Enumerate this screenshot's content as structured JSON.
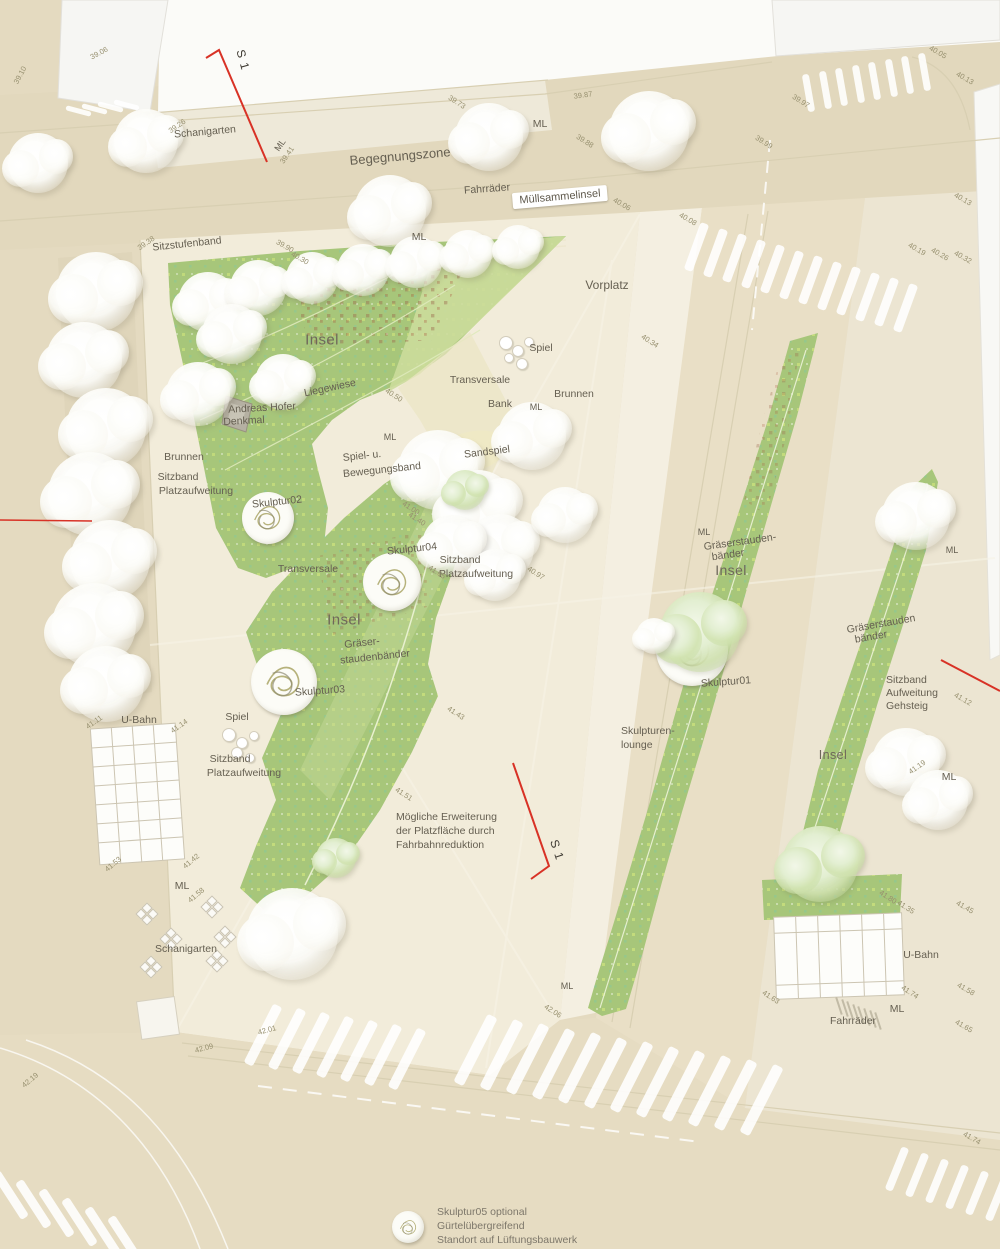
{
  "plan_title": "Site plan (Platzgestaltung)",
  "palette": {
    "street": "#e4dac0",
    "road": "#e9dfc6",
    "plaza": "#f2ecda",
    "sidewalk": "#ece5d2",
    "lounge": "#f4efe1",
    "schani": "#eee9d9",
    "paper": "#fbfbf8",
    "building": "#f6f6f3",
    "green": "#a7c67a",
    "greenlight": "#c3d795",
    "pale": "#dfe7b4",
    "sand": "#efe9c5",
    "red": "#d83226",
    "label": "#655f51",
    "elev": "#97906f",
    "grid": "#ccc5b2",
    "curb": "#d8cfb2"
  },
  "labels": [
    {
      "id": "schanigarten-top",
      "t": "Schanigarten",
      "x": 205,
      "y": 132,
      "r": -5
    },
    {
      "id": "ml-1",
      "t": "ML",
      "x": 280,
      "y": 145,
      "r": -55,
      "c": "small"
    },
    {
      "id": "begegnungszone",
      "t": "Begegnungszone",
      "x": 400,
      "y": 156,
      "r": -5,
      "c": "big2"
    },
    {
      "id": "fahrraeder-top",
      "t": "Fahrräder",
      "x": 487,
      "y": 189,
      "r": -4
    },
    {
      "id": "ml-2",
      "t": "ML",
      "x": 540,
      "y": 124,
      "r": 0
    },
    {
      "id": "muellsammelinsel",
      "t": "Müllsammelinsel",
      "x": 560,
      "y": 197,
      "r": -5,
      "c": "boxed"
    },
    {
      "id": "sitzstufenband",
      "t": "Sitzstufenband",
      "x": 187,
      "y": 244,
      "r": -6
    },
    {
      "id": "ml-3",
      "t": "ML",
      "x": 419,
      "y": 237,
      "r": 0
    },
    {
      "id": "insel-a",
      "t": "Insel",
      "x": 322,
      "y": 340,
      "r": 0,
      "c": "big"
    },
    {
      "id": "vorplatz",
      "t": "Vorplatz",
      "x": 607,
      "y": 285,
      "r": 0,
      "c": "med2"
    },
    {
      "id": "spiel-1",
      "t": "Spiel",
      "x": 541,
      "y": 348,
      "r": 0
    },
    {
      "id": "transversale-1",
      "t": "Transversale",
      "x": 480,
      "y": 380,
      "r": 0
    },
    {
      "id": "bank",
      "t": "Bank",
      "x": 500,
      "y": 404,
      "r": 0
    },
    {
      "id": "ml-4",
      "t": "ML",
      "x": 536,
      "y": 407,
      "r": 0,
      "c": "small"
    },
    {
      "id": "brunnen-1",
      "t": "Brunnen",
      "x": 574,
      "y": 394,
      "r": 0
    },
    {
      "id": "liegewiese",
      "t": "Liegewiese",
      "x": 330,
      "y": 388,
      "r": -12
    },
    {
      "id": "andreas-hofer-1",
      "t": "Andreas Hofer",
      "x": 262,
      "y": 408,
      "r": -3
    },
    {
      "id": "andreas-hofer-2",
      "t": "Denkmal",
      "x": 244,
      "y": 421,
      "r": -3
    },
    {
      "id": "ml-5",
      "t": "ML",
      "x": 390,
      "y": 437,
      "r": 0,
      "c": "small"
    },
    {
      "id": "spielband-1",
      "t": "Spiel- u.",
      "x": 362,
      "y": 456,
      "r": -6
    },
    {
      "id": "spielband-2",
      "t": "Bewegungsband",
      "x": 382,
      "y": 470,
      "r": -6
    },
    {
      "id": "sandspiel",
      "t": "Sandspiel",
      "x": 487,
      "y": 452,
      "r": -7
    },
    {
      "id": "brunnen-2",
      "t": "Brunnen",
      "x": 184,
      "y": 457,
      "r": 0
    },
    {
      "id": "sitzband-1a",
      "t": "Sitzband",
      "x": 178,
      "y": 477,
      "r": 0
    },
    {
      "id": "sitzband-1b",
      "t": "Platzaufweitung",
      "x": 196,
      "y": 491,
      "r": 0
    },
    {
      "id": "skulptur02",
      "t": "Skulptur02",
      "x": 277,
      "y": 502,
      "r": -6
    },
    {
      "id": "transversale-2",
      "t": "Transversale",
      "x": 308,
      "y": 569,
      "r": 0
    },
    {
      "id": "skulptur04",
      "t": "Skulptur04",
      "x": 412,
      "y": 549,
      "r": -6
    },
    {
      "id": "sitzband-2a",
      "t": "Sitzband",
      "x": 460,
      "y": 560,
      "r": 0
    },
    {
      "id": "sitzband-2b",
      "t": "Platzaufweitung",
      "x": 476,
      "y": 574,
      "r": 0
    },
    {
      "id": "insel-b",
      "t": "Insel",
      "x": 344,
      "y": 620,
      "r": 0,
      "c": "big"
    },
    {
      "id": "graeser-b1",
      "t": "Gräser-",
      "x": 362,
      "y": 643,
      "r": -6
    },
    {
      "id": "graeser-b2",
      "t": "staudenbänder",
      "x": 375,
      "y": 657,
      "r": -6
    },
    {
      "id": "skulptur03",
      "t": "Skulptur03",
      "x": 320,
      "y": 691,
      "r": -4
    },
    {
      "id": "ubahn-1",
      "t": "U-Bahn",
      "x": 139,
      "y": 720,
      "r": 0
    },
    {
      "id": "spiel-2",
      "t": "Spiel",
      "x": 237,
      "y": 717,
      "r": 0
    },
    {
      "id": "sitzband-3a",
      "t": "Sitzband",
      "x": 230,
      "y": 759,
      "r": 0
    },
    {
      "id": "sitzband-3b",
      "t": "Platzaufweitung",
      "x": 244,
      "y": 773,
      "r": 0
    },
    {
      "id": "erweiterung-1",
      "t": "Mögliche Erweiterung",
      "x": 396,
      "y": 817,
      "r": 0,
      "a": "l"
    },
    {
      "id": "erweiterung-2",
      "t": "der Platzfläche durch",
      "x": 396,
      "y": 831,
      "r": 0,
      "a": "l"
    },
    {
      "id": "erweiterung-3",
      "t": "Fahrbahnreduktion",
      "x": 396,
      "y": 845,
      "r": 0,
      "a": "l"
    },
    {
      "id": "s1-bottom",
      "t": "S 1",
      "x": 557,
      "y": 850,
      "r": 72,
      "c": "s1"
    },
    {
      "id": "s1-top",
      "t": "S 1",
      "x": 243,
      "y": 60,
      "r": 75,
      "c": "s1"
    },
    {
      "id": "ml-6",
      "t": "ML",
      "x": 182,
      "y": 886,
      "r": 0
    },
    {
      "id": "schanigarten-2",
      "t": "Schanigarten",
      "x": 186,
      "y": 949,
      "r": 0
    },
    {
      "id": "lounge-1",
      "t": "Skulpturen-",
      "x": 621,
      "y": 731,
      "r": 0,
      "a": "l"
    },
    {
      "id": "lounge-2",
      "t": "lounge",
      "x": 621,
      "y": 745,
      "r": 0,
      "a": "l"
    },
    {
      "id": "ml-7",
      "t": "ML",
      "x": 704,
      "y": 532,
      "r": 0,
      "c": "small"
    },
    {
      "id": "graeser-c1",
      "t": "Gräserstauden-",
      "x": 740,
      "y": 542,
      "r": -8
    },
    {
      "id": "graeser-c2",
      "t": "bänder",
      "x": 728,
      "y": 555,
      "r": -8
    },
    {
      "id": "insel-c",
      "t": "Insel",
      "x": 731,
      "y": 570,
      "r": 0,
      "c": "big",
      "fs": 14
    },
    {
      "id": "skulptur01",
      "t": "Skulptur01",
      "x": 726,
      "y": 682,
      "r": -4
    },
    {
      "id": "graeser-d1",
      "t": "Gräserstauden",
      "x": 881,
      "y": 624,
      "r": -10
    },
    {
      "id": "graeser-d2",
      "t": "bänder",
      "x": 871,
      "y": 637,
      "r": -10
    },
    {
      "id": "sitzband-4a",
      "t": "Sitzband",
      "x": 886,
      "y": 680,
      "r": 0,
      "a": "l"
    },
    {
      "id": "sitzband-4b",
      "t": "Aufweitung",
      "x": 886,
      "y": 693,
      "r": 0,
      "a": "l"
    },
    {
      "id": "sitzband-4c",
      "t": "Gehsteig",
      "x": 886,
      "y": 706,
      "r": 0,
      "a": "l"
    },
    {
      "id": "insel-d",
      "t": "Insel",
      "x": 833,
      "y": 755,
      "r": 0,
      "c": "big",
      "fs": 12.5
    },
    {
      "id": "ml-8",
      "t": "ML",
      "x": 949,
      "y": 777,
      "r": 0
    },
    {
      "id": "ml-9",
      "t": "ML",
      "x": 952,
      "y": 550,
      "r": 0,
      "c": "small"
    },
    {
      "id": "ubahn-2",
      "t": "U-Bahn",
      "x": 921,
      "y": 955,
      "r": 0
    },
    {
      "id": "fahrraeder-2",
      "t": "Fahrräder",
      "x": 853,
      "y": 1021,
      "r": 0
    },
    {
      "id": "ml-10",
      "t": "ML",
      "x": 897,
      "y": 1009,
      "r": 0
    },
    {
      "id": "ml-11",
      "t": "ML",
      "x": 567,
      "y": 986,
      "r": 0,
      "c": "small"
    },
    {
      "id": "sk05-1",
      "t": "Skulptur05 optional",
      "x": 437,
      "y": 1212,
      "r": 0,
      "a": "l",
      "c": "note"
    },
    {
      "id": "sk05-2",
      "t": "Gürtelübergreifend",
      "x": 437,
      "y": 1226,
      "r": 0,
      "a": "l",
      "c": "note"
    },
    {
      "id": "sk05-3",
      "t": "Standort auf Lüftungsbauwerk",
      "x": 437,
      "y": 1240,
      "r": 0,
      "a": "l",
      "c": "note"
    }
  ],
  "elevations": [
    [
      "39.06",
      99,
      53,
      -28
    ],
    [
      "39.10",
      20,
      75,
      -62
    ],
    [
      "39.26",
      177,
      126,
      -35
    ],
    [
      "39.41",
      287,
      155,
      -55
    ],
    [
      "39.73",
      457,
      102,
      33
    ],
    [
      "39.87",
      583,
      95,
      -8
    ],
    [
      "39.88",
      585,
      141,
      33
    ],
    [
      "39.97",
      801,
      101,
      33
    ],
    [
      "39.99",
      764,
      142,
      33
    ],
    [
      "40.05",
      938,
      52,
      30
    ],
    [
      "40.13",
      965,
      78,
      30
    ],
    [
      "40.13",
      963,
      199,
      30
    ],
    [
      "40.19",
      917,
      249,
      30
    ],
    [
      "40.26",
      940,
      254,
      30
    ],
    [
      "40.32",
      963,
      257,
      30
    ],
    [
      "40.06",
      622,
      204,
      30
    ],
    [
      "40.08",
      688,
      219,
      30
    ],
    [
      "39.38",
      146,
      243,
      -35
    ],
    [
      "39.90",
      285,
      246,
      30
    ],
    [
      "40.30",
      300,
      258,
      30
    ],
    [
      "40.34",
      650,
      341,
      33
    ],
    [
      "40.50",
      394,
      395,
      33
    ],
    [
      "41.00",
      411,
      508,
      33
    ],
    [
      "41.40",
      417,
      519,
      33
    ],
    [
      "41.65",
      437,
      572,
      33
    ],
    [
      "40.97",
      536,
      573,
      33
    ],
    [
      "41.43",
      456,
      713,
      33
    ],
    [
      "41.51",
      404,
      794,
      33
    ],
    [
      "41.11",
      94,
      722,
      -35
    ],
    [
      "41.14",
      179,
      726,
      -35
    ],
    [
      "41.53",
      113,
      864,
      -40
    ],
    [
      "41.42",
      191,
      861,
      -40
    ],
    [
      "41.58",
      196,
      895,
      -40
    ],
    [
      "42.01",
      267,
      1030,
      -15
    ],
    [
      "42.09",
      204,
      1048,
      -15
    ],
    [
      "42.06",
      553,
      1011,
      33
    ],
    [
      "41.80",
      888,
      897,
      33
    ],
    [
      "41.35",
      906,
      907,
      33
    ],
    [
      "41.74",
      910,
      992,
      33
    ],
    [
      "41.63",
      771,
      997,
      33
    ],
    [
      "41.45",
      965,
      907,
      30
    ],
    [
      "41.58",
      966,
      989,
      30
    ],
    [
      "41.65",
      964,
      1026,
      30
    ],
    [
      "41.12",
      963,
      699,
      30
    ],
    [
      "41.19",
      917,
      767,
      -35
    ],
    [
      "42.19",
      30,
      1080,
      -40
    ],
    [
      "41.74",
      972,
      1138,
      30
    ]
  ],
  "features": {
    "trees": [
      [
        38,
        163,
        30,
        "w"
      ],
      [
        146,
        141,
        32,
        "w"
      ],
      [
        390,
        211,
        36,
        "w"
      ],
      [
        489,
        137,
        34,
        "w"
      ],
      [
        649,
        131,
        40,
        "w"
      ],
      [
        96,
        292,
        40,
        "w"
      ],
      [
        84,
        360,
        38,
        "w"
      ],
      [
        106,
        428,
        40,
        "w"
      ],
      [
        90,
        494,
        42,
        "w"
      ],
      [
        110,
        560,
        40,
        "w"
      ],
      [
        94,
        625,
        42,
        "w"
      ],
      [
        106,
        684,
        38,
        "w"
      ],
      [
        208,
        302,
        30,
        "w"
      ],
      [
        258,
        288,
        28,
        "w"
      ],
      [
        312,
        278,
        26,
        "w"
      ],
      [
        363,
        270,
        26,
        "w"
      ],
      [
        416,
        262,
        26,
        "w"
      ],
      [
        468,
        254,
        24,
        "w"
      ],
      [
        518,
        247,
        22,
        "w"
      ],
      [
        232,
        334,
        30,
        "w"
      ],
      [
        198,
        394,
        32,
        "w"
      ],
      [
        283,
        382,
        28,
        "w"
      ],
      [
        438,
        470,
        40,
        "w"
      ],
      [
        478,
        508,
        38,
        "w"
      ],
      [
        500,
        548,
        34,
        "w"
      ],
      [
        452,
        545,
        30,
        "w"
      ],
      [
        465,
        490,
        20,
        "g"
      ],
      [
        495,
        575,
        26,
        "w"
      ],
      [
        565,
        515,
        28,
        "w"
      ],
      [
        532,
        436,
        34,
        "w"
      ],
      [
        700,
        632,
        40,
        "g"
      ],
      [
        654,
        636,
        18,
        "w"
      ],
      [
        916,
        516,
        34,
        "w"
      ],
      [
        906,
        762,
        34,
        "w"
      ],
      [
        938,
        800,
        30,
        "w"
      ],
      [
        820,
        864,
        38,
        "g"
      ],
      [
        292,
        934,
        46,
        "w"
      ],
      [
        336,
        858,
        20,
        "g"
      ]
    ],
    "sculptures": [
      {
        "id": "skulptur02",
        "x": 268,
        "y": 518,
        "r": 26
      },
      {
        "id": "skulptur04",
        "x": 392,
        "y": 582,
        "r": 29
      },
      {
        "id": "skulptur03",
        "x": 284,
        "y": 682,
        "r": 33
      },
      {
        "id": "skulptur01",
        "x": 692,
        "y": 650,
        "r": 36
      },
      {
        "id": "skulptur05",
        "x": 408,
        "y": 1227,
        "r": 16
      }
    ],
    "crosswalks": [
      {
        "x": 805,
        "y": 74,
        "n": 8,
        "dx": 16.5,
        "dy": -3,
        "w": 7,
        "h": 38,
        "rot": -10
      },
      {
        "x": 692,
        "y": 222,
        "n": 12,
        "dx": 19,
        "dy": 5.5,
        "w": 9,
        "h": 50,
        "rot": 20
      },
      {
        "x": 258,
        "y": 1002,
        "n": 7,
        "dx": 24,
        "dy": 4,
        "w": 10,
        "h": 66,
        "rot": 27
      },
      {
        "x": 470,
        "y": 1012,
        "n": 12,
        "dx": 26,
        "dy": 4.5,
        "w": 11,
        "h": 76,
        "rot": 27
      },
      {
        "x": 6,
        "y": 1168,
        "n": 6,
        "dx": 23,
        "dy": 9,
        "w": 9,
        "h": 54,
        "rot": -33
      },
      {
        "x": 893,
        "y": 1146,
        "n": 6,
        "dx": 20,
        "dy": 6,
        "w": 8,
        "h": 46,
        "rot": 22
      },
      {
        "x": 76,
        "y": 98,
        "n": 4,
        "dx": 16,
        "dy": -2,
        "w": 5,
        "h": 26,
        "rot": -75
      }
    ],
    "bike_racks": {
      "x": 838,
      "y": 997,
      "n": 8,
      "dx": 5.6,
      "dy": 2.2,
      "len": 18,
      "rot": -18
    },
    "schanigarten_tables": [
      [
        138,
        905
      ],
      [
        203,
        898
      ],
      [
        162,
        930
      ],
      [
        216,
        928
      ],
      [
        142,
        958
      ],
      [
        208,
        952
      ]
    ],
    "play_elements": [
      [
        505,
        342,
        6
      ],
      [
        517,
        350,
        5
      ],
      [
        528,
        341,
        4
      ],
      [
        508,
        357,
        4
      ],
      [
        521,
        363,
        5
      ],
      [
        228,
        734,
        6
      ],
      [
        241,
        742,
        5
      ],
      [
        253,
        735,
        4
      ],
      [
        236,
        752,
        5
      ],
      [
        249,
        757,
        4
      ]
    ]
  }
}
